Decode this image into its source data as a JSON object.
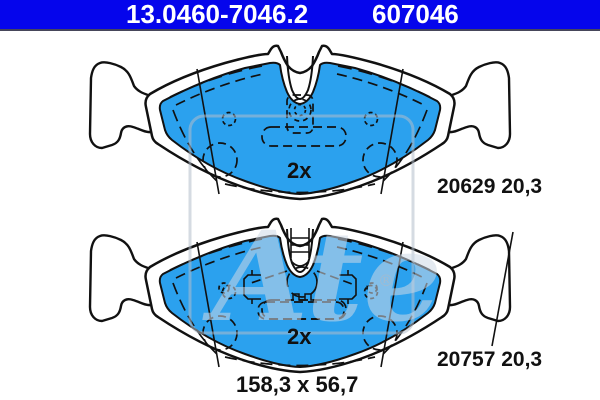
{
  "header": {
    "catalog_number": "13.0460-7046.2",
    "oe_number": "607046",
    "bg_color": "#0505ec",
    "text_color": "#ffffff"
  },
  "drawing": {
    "pad_top": {
      "wva_thickness_label": "20629 20,3",
      "quantity_label": "2x"
    },
    "pad_bottom": {
      "wva_thickness_label": "20757 20,3",
      "quantity_label": "2x"
    },
    "dimensions_label": "158,3 x 56,7",
    "watermark": {
      "brand_script": "Ate",
      "registered_mark": "®"
    },
    "colors": {
      "friction_fill": "#2ba1ee",
      "outline": "#111111",
      "watermark": "#cdd9e6"
    }
  }
}
